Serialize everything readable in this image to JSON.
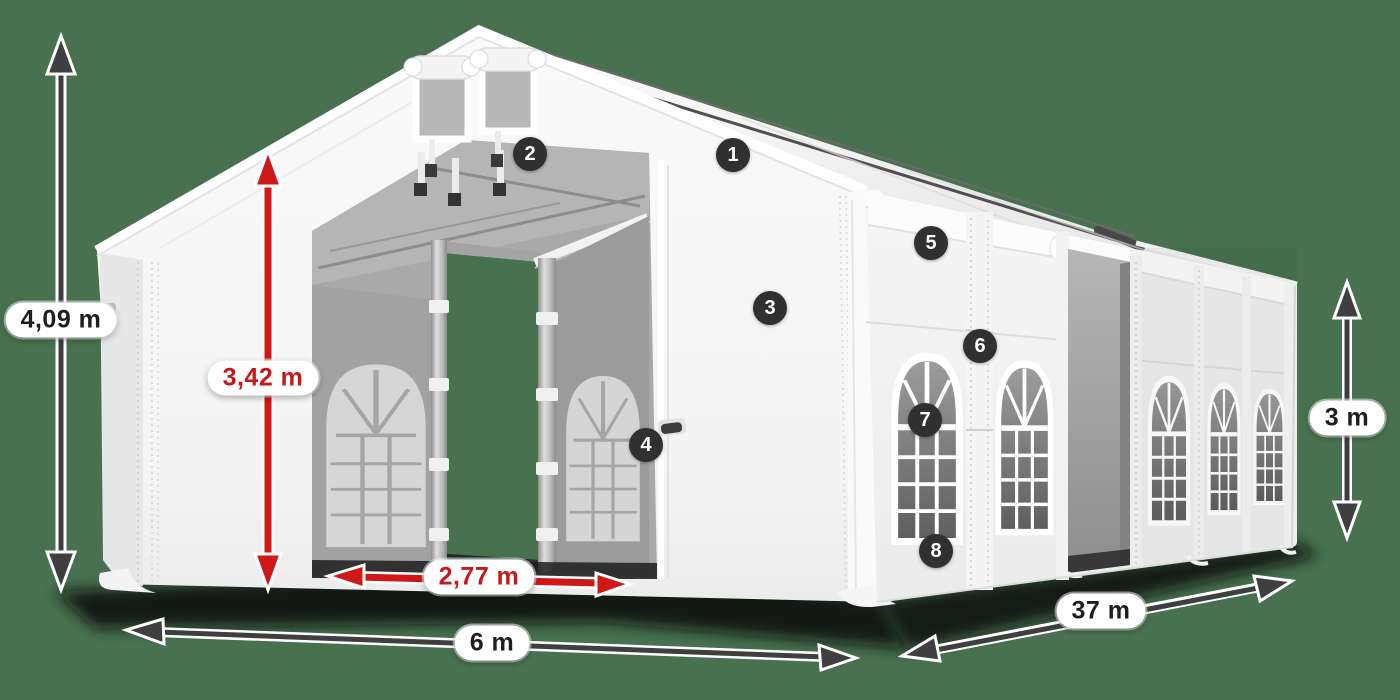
{
  "scene": {
    "title": "tent-dimensions-diagram"
  },
  "colors": {
    "background": "#47714f",
    "accent_red": "#d01818",
    "arrow_dark": "#3f3f3f",
    "marker_bg": "#303030",
    "marker_text": "#ffffff",
    "pill_bg": "#ffffff"
  },
  "dimensions": {
    "total_height": {
      "label": "4,09 m"
    },
    "entrance_height": {
      "label": "3,42 m"
    },
    "entrance_width": {
      "label": "2,77 m"
    },
    "front_width": {
      "label": "6 m"
    },
    "length": {
      "label": "37 m"
    },
    "side_height": {
      "label": "3 m"
    }
  },
  "markers": [
    {
      "label": "1"
    },
    {
      "label": "2"
    },
    {
      "label": "3"
    },
    {
      "label": "4"
    },
    {
      "label": "5"
    },
    {
      "label": "6"
    },
    {
      "label": "7"
    },
    {
      "label": "8"
    }
  ]
}
